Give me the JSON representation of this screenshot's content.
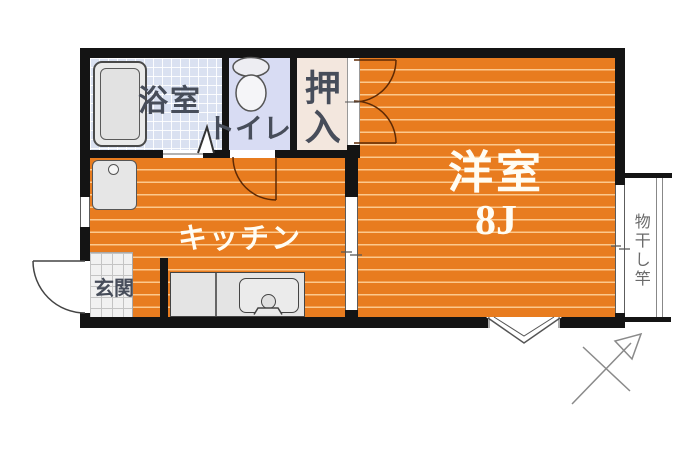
{
  "floor_plan": {
    "rooms": {
      "bathroom": {
        "name": "浴室"
      },
      "toilet": {
        "name": "トイレ"
      },
      "closet": {
        "name": "押入"
      },
      "western_room": {
        "name": "洋室",
        "size_label": "8J"
      },
      "kitchen": {
        "name": "キッチン"
      },
      "entrance": {
        "name": "玄関"
      }
    },
    "balcony": {
      "laundry_pole_label": "物干し竿"
    },
    "symbols": [
      "bathtub",
      "toilet-fixture",
      "washing-machine-pan",
      "kitchen-counter-sink",
      "entrance-door-swing",
      "toilet-door-swing",
      "closet-double-door-swing",
      "bathroom-folding-door",
      "sliding-door",
      "balcony-sliding-window",
      "bay-window",
      "north-arrow-compass",
      "window"
    ],
    "colors": {
      "wall": "#141414",
      "flooring_orange": "#e87c1f",
      "bathroom_tile": "#dae1f1",
      "toilet_floor": "#d8dcf3",
      "closet_floor": "#f3e7de",
      "entrance_tile": "#f1f1f1",
      "label_dark": "#474d5a",
      "label_light": "#fffdf4"
    }
  }
}
